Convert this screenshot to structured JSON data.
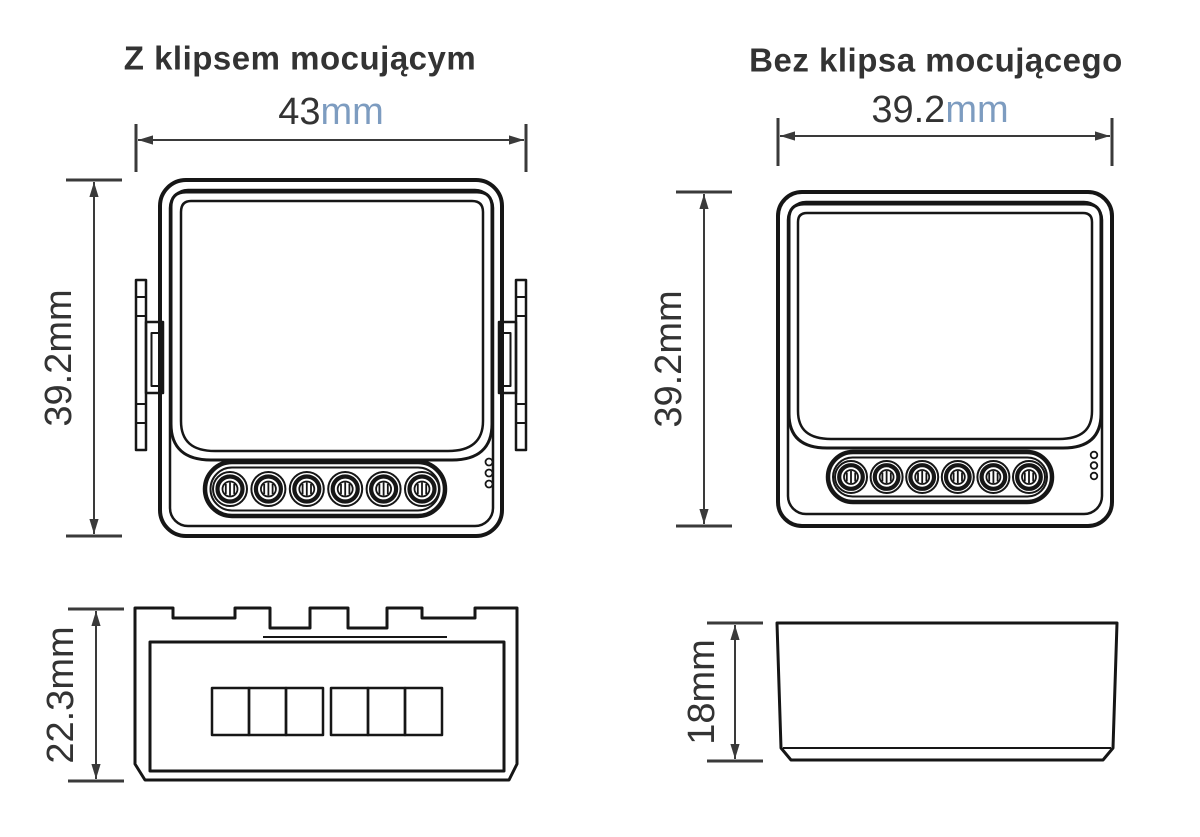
{
  "left_device": {
    "title": "Z klipsem mocującym",
    "width_dim": {
      "value": "43",
      "unit": "mm"
    },
    "height_dim": {
      "value": "39.2",
      "unit": "mm"
    },
    "depth_dim": {
      "value": "22.3",
      "unit": "mm"
    }
  },
  "right_device": {
    "title": "Bez klipsa mocującego",
    "width_dim": {
      "value": "39.2",
      "unit": "mm"
    },
    "height_dim": {
      "value": "39.2",
      "unit": "mm"
    },
    "depth_dim": {
      "value": "18",
      "unit": "mm"
    }
  },
  "colors": {
    "outline": "#161616",
    "dimension": "#3a3a3a",
    "text": "#333333",
    "unit_accent": "#7d9cc0"
  }
}
